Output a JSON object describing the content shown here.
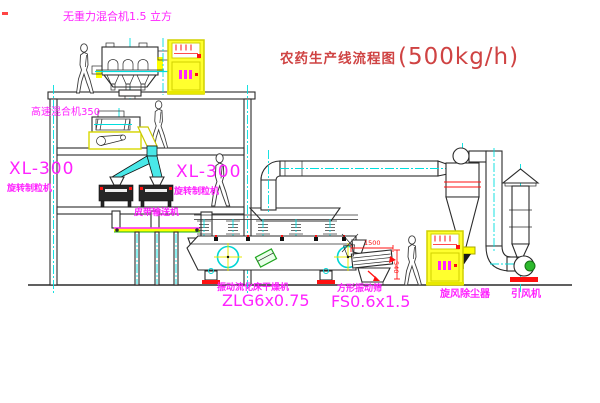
{
  "title": {
    "text": "农药生产线流程图",
    "rate": "(500kg/h)"
  },
  "labels": {
    "mixer_top": "无重力混合机1.5 立方",
    "mixer_highspeed": "高速混合机350",
    "granulator_left_model": "XL-300",
    "granulator_left_name": "旋转制粒机",
    "granulator_right_model": "XL-300",
    "granulator_right_name": "旋转制粒机",
    "belt_conveyor": "皮带输送机",
    "dryer_name": "振动流化床干燥机",
    "dryer_model": "ZLG6x0.75",
    "screen_name": "方形振动筛",
    "screen_model": "FS0.6x1.5",
    "cyclone": "旋风除尘器",
    "fan": "引风机"
  },
  "dimensions": {
    "screen_length": "1500",
    "screen_height": "540"
  },
  "colors": {
    "label_magenta": "#ff22ff",
    "title_red": "#cf4343",
    "dimension_red": "#ff1111",
    "cabinet_yellow": "#ffff2e",
    "centerline_cyan": "#00dede",
    "motor_green": "#2db82d",
    "line_black": "#2b2b2b"
  }
}
